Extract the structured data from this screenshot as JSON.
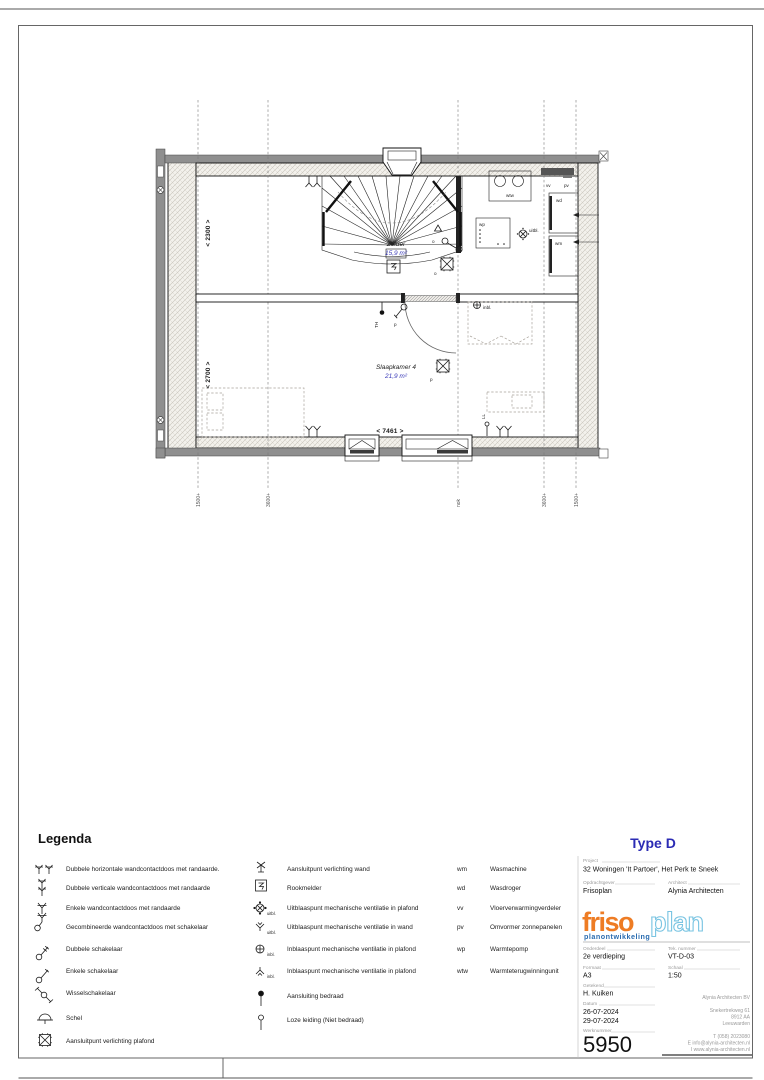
{
  "colors": {
    "blue-label": "#3a3ab8",
    "type-blue": "#2b2bb4",
    "logo-orange": "#ee7c24",
    "logo-lightblue": "#79c4e2",
    "logo-darkblue": "#2a6cb0"
  },
  "plan": {
    "rooms": [
      {
        "name": "Zolder",
        "area": "15,9 m²"
      },
      {
        "name": "Slaapkamer 4",
        "area": "21,9 m²"
      }
    ],
    "dimensions": {
      "width": "< 7461 >",
      "zolder_depth": "< 2300 >",
      "slaapkamer_depth": "< 2700 >"
    },
    "grid_labels": [
      "1500+",
      "3600+",
      "nok",
      "3600+",
      "1500+"
    ],
    "labels": {
      "wtw": "wtw",
      "vv": "vv",
      "pv": "pv",
      "wd": "wd",
      "wm": "wm",
      "wp": "wp",
      "uitbl": "uitbl.",
      "inbl": "inbl.",
      "th": "TH",
      "ll": "LL",
      "p": "p",
      "o": "o"
    }
  },
  "legend": {
    "title": "Legenda",
    "left": [
      {
        "label": "Dubbele horizontale wandcontactdoos met randaarde."
      },
      {
        "label": "Dubbele verticale wandcontactdoos met randaarde"
      },
      {
        "label": "Enkele wandcontactdoos met randaarde"
      },
      {
        "label": "Gecombineerde wandcontactdoos met schakelaar"
      },
      {
        "label": "Dubbele schakelaar"
      },
      {
        "label": "Enkele schakelaar"
      },
      {
        "label": "Wisselschakelaar"
      },
      {
        "label": "Schel"
      },
      {
        "label": "Aansluitpunt verlichting plafond"
      }
    ],
    "middle": [
      {
        "label": "Aansluitpunt verlichting wand"
      },
      {
        "label": "Rookmelder"
      },
      {
        "label": "Uitblaaspunt mechanische ventilatie in plafond",
        "tag": "uitbl."
      },
      {
        "label": "Uitblaaspunt mechanische ventilatie in wand",
        "tag": "uitbl."
      },
      {
        "label": "Inblaaspunt mechanische ventilatie in plafond",
        "tag": "inbl."
      },
      {
        "label": "Inblaaspunt mechanische ventilatie in plafond",
        "tag": "inbl."
      },
      {
        "label": "Aansluiting bedraad"
      },
      {
        "label": "Loze leiding (Niet bedraad)"
      }
    ],
    "right": [
      {
        "abbr": "wm",
        "label": "Wasmachine"
      },
      {
        "abbr": "wd",
        "label": "Wasdroger"
      },
      {
        "abbr": "vv",
        "label": "Vloerverwarmingverdeler"
      },
      {
        "abbr": "pv",
        "label": "Omvormer zonnepanelen"
      },
      {
        "abbr": "wp",
        "label": "Warmtepomp"
      },
      {
        "abbr": "wtw",
        "label": "Warmteterugwinningunit"
      }
    ]
  },
  "titleblock": {
    "type": "Type D",
    "project_label": "Project",
    "project": "32 Woningen 'It Partoer', Het Perk te Sneek",
    "opdrachtgever_label": "Opdrachtgever",
    "opdrachtgever": "Frisoplan",
    "architect_label": "Architect",
    "architect": "Alynia Architecten",
    "logo": {
      "friso": "friso",
      "plan": "plan",
      "sub": "planontwikkeling"
    },
    "onderdeel_label": "Onderdeel",
    "onderdeel": "2e verdieping",
    "tek_label": "Tek. nummer",
    "tek": "VT-D-03",
    "formaat_label": "Formaat",
    "formaat": "A3",
    "schaal_label": "Schaal",
    "schaal": "1:50",
    "getekend_label": "Getekend",
    "getekend": "H. Kuiken",
    "datum_label": "Datum",
    "datum1": "26-07-2024",
    "datum2": "29-07-2024",
    "werknummer_label": "Werknummer",
    "werknummer": "5950",
    "office": [
      "Alynia Architecten BV",
      "Snekertrekweg 61",
      "8912 AA",
      "Leeuwarden",
      "T (058) 2023080",
      "E info@alynia-architecten.nl",
      "I www.alynia-architecten.nl"
    ]
  }
}
